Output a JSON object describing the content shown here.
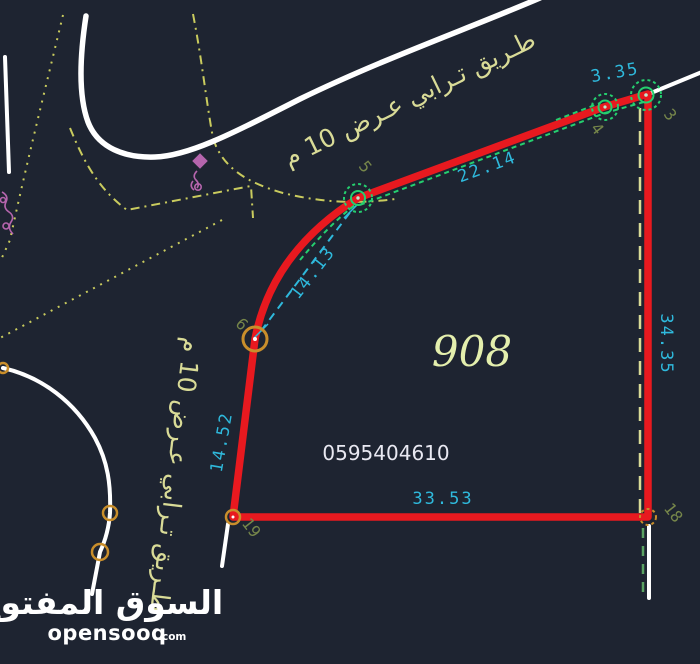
{
  "drawing": {
    "parcel": {
      "number": "908",
      "phone": "0595404610",
      "dimensions": {
        "edge_3_4": "3.35",
        "edge_4_5": "22.14",
        "chord_5_6": "14.13",
        "edge_18_3": "34.35",
        "edge_19_18": "33.53",
        "edge_6_19": "14.52"
      },
      "points": {
        "p3": "3",
        "p4": "4",
        "p5": "5",
        "p6": "6",
        "p18": "18",
        "p19": "19"
      }
    },
    "roads": {
      "label_top": "طـريق تـرابي عـرض 10 م",
      "label_left": "طـريق تـرابي عـرض 10 م"
    },
    "watermark": {
      "arabic": "السوق المفتوح",
      "latin": "opensooq",
      "tld": ".com"
    }
  },
  "colors": {
    "bg": "#1e2431",
    "red": "#e8191f",
    "cyan": "#2fb9dc",
    "khaki": "#d9db97",
    "road-edge": "#c9cb5e",
    "green": "#25cf6f",
    "sage": "#5ba363",
    "olive": "#76864a",
    "orange": "#c98e2b",
    "magenta": "#b565ad",
    "parcel-num": "#e4efad",
    "phone": "#e9e9f2",
    "white": "#ffffff"
  }
}
